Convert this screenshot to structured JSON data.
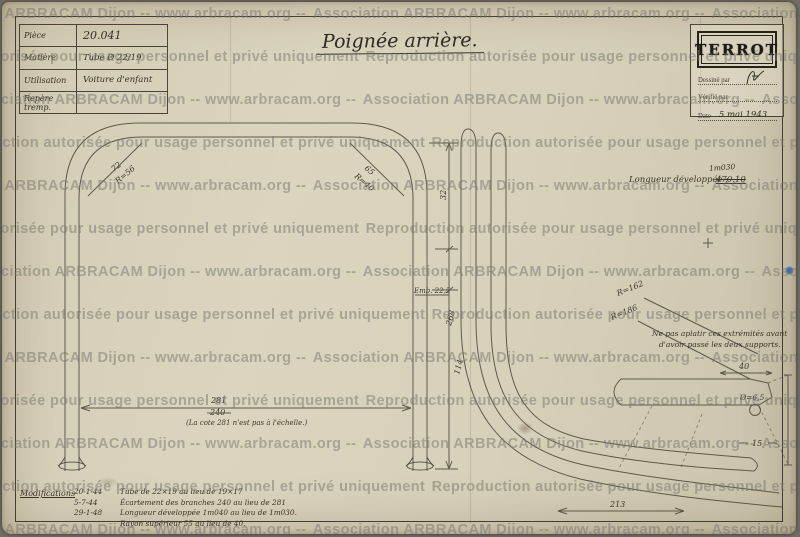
{
  "watermark": {
    "line_a": "Association ARBRACAM Dijon -- www.arbracam.org -- ",
    "line_b": "Reproduction autorisée pour usage personnel et privé uniquement "
  },
  "info_table": {
    "rows": [
      {
        "label": "Pièce",
        "value": "20.041"
      },
      {
        "label": "Matière",
        "value": "Tube Ø 22/19"
      },
      {
        "label": "Utilisation",
        "value": "Voiture d'enfant"
      },
      {
        "label": "Repère tremp.",
        "value": ""
      }
    ]
  },
  "title": "Poignée arrière.",
  "stamp": {
    "logo": "TERROT",
    "drawn_by_label": "Dessiné par",
    "checked_by_label": "Vérifié par",
    "date_label": "Date",
    "date_value": "5 mai 1943"
  },
  "left_view": {
    "corner_left_dim": "72",
    "corner_left_radius": "R=56",
    "corner_right_dim": "65",
    "corner_right_radius": "R=40",
    "chain_top": "32",
    "tube_label": "Emb. 22,5",
    "chain_mid": "268",
    "chain_low": "114",
    "width_value": "281",
    "width_old_value": "240",
    "scale_note": "(La cote 281 n'est pas à l'échelle.)"
  },
  "right_view": {
    "length_label": "Longueur développée :",
    "length_old": "470.10",
    "length_new": "1m030",
    "radius_outer": "R=162",
    "radius_inner": "R=186",
    "note_line1": "Ne pas aplatir ces extrémités avant",
    "note_line2": "d'avoir passé les deux supports.",
    "dim_width_tip": "40",
    "dim_hole": "Ø=6,5",
    "dim_15": "15",
    "dim_213": "213"
  },
  "modifications": {
    "label": "Modifications",
    "rows": [
      {
        "date": "20-1-44",
        "text": "Tube de 22×19 au lieu de 19×17"
      },
      {
        "date": "5-7-44",
        "text": "Écartement des branches 240 au lieu de 281"
      },
      {
        "date": "29-1-48",
        "text": "Longueur développée 1m040 au lieu de 1m030."
      },
      {
        "date": "",
        "text": "Rayon supérieur 55 au lieu de 40."
      }
    ]
  }
}
